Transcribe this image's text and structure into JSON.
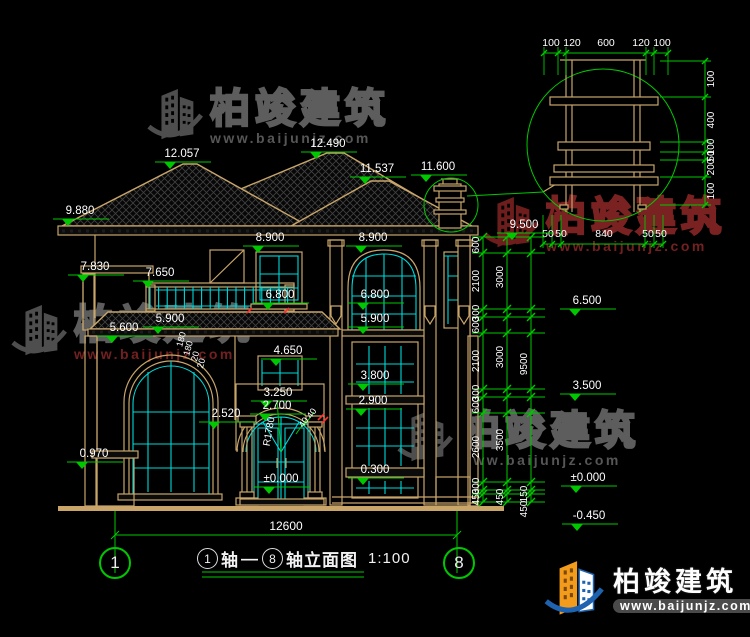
{
  "watermark": {
    "brand": "柏竣建筑",
    "url": "www.baijunjz.com"
  },
  "logo": {
    "brand": "柏竣建筑",
    "url": "www.baijunjz.com"
  },
  "caption": {
    "from": "1",
    "word1": "轴",
    "dash": "—",
    "to": "8",
    "word2": "轴立面图",
    "scale": "1:100"
  },
  "axes": {
    "left": "1",
    "right": "8"
  },
  "dims": {
    "overall": "12600"
  },
  "colors": {
    "green": "#00c800",
    "tan": "#c9a56a",
    "cyan": "#00d8d8",
    "white": "#ffffff",
    "red": "#ff3030"
  },
  "anno": {
    "levels": [
      {
        "t": "12.057",
        "x": 182,
        "y": 157
      },
      {
        "t": "12.490",
        "x": 328,
        "y": 147
      },
      {
        "t": "11.537",
        "x": 377,
        "y": 172
      },
      {
        "t": "11.600",
        "x": 438,
        "y": 170
      },
      {
        "t": "9.880",
        "x": 80,
        "y": 214
      },
      {
        "t": "8.900",
        "x": 270,
        "y": 241
      },
      {
        "t": "8.900",
        "x": 373,
        "y": 241
      },
      {
        "t": "7.830",
        "x": 95,
        "y": 270
      },
      {
        "t": "7.650",
        "x": 160,
        "y": 276
      },
      {
        "t": "6.800",
        "x": 280,
        "y": 298
      },
      {
        "t": "6.800",
        "x": 375,
        "y": 298
      },
      {
        "t": "5.900",
        "x": 170,
        "y": 322
      },
      {
        "t": "5.900",
        "x": 375,
        "y": 322
      },
      {
        "t": "5.600",
        "x": 124,
        "y": 331
      },
      {
        "t": "4.650",
        "x": 288,
        "y": 354
      },
      {
        "t": "3.800",
        "x": 375,
        "y": 379
      },
      {
        "t": "3.250",
        "x": 278,
        "y": 396
      },
      {
        "t": "2.700",
        "x": 277,
        "y": 409
      },
      {
        "t": "2.900",
        "x": 373,
        "y": 404
      },
      {
        "t": "2.520",
        "x": 226,
        "y": 417
      },
      {
        "t": "0.970",
        "x": 94,
        "y": 457
      },
      {
        "t": "0.300",
        "x": 375,
        "y": 473
      },
      {
        "t": "±0.000",
        "x": 281,
        "y": 482
      },
      {
        "t": "9.500",
        "x": 524,
        "y": 228
      },
      {
        "t": "6.500",
        "x": 587,
        "y": 304
      },
      {
        "t": "3.500",
        "x": 587,
        "y": 389
      },
      {
        "t": "±0.000",
        "x": 588,
        "y": 481
      },
      {
        "t": "-0.450",
        "x": 589,
        "y": 519
      }
    ],
    "chain_tick_ys": [
      237,
      253,
      309,
      317,
      333,
      389,
      397,
      413,
      482,
      490,
      494,
      502
    ],
    "chains": [
      {
        "x": 483,
        "labels": [
          [
            "600",
            245
          ],
          [
            "2100",
            281
          ],
          [
            "300",
            313
          ],
          [
            "600",
            325
          ],
          [
            "2100",
            361
          ],
          [
            "300",
            393
          ],
          [
            "600",
            405
          ],
          [
            "2600",
            447
          ],
          [
            "300",
            486
          ],
          [
            "450",
            497
          ]
        ]
      },
      {
        "x": 507,
        "labels": [
          [
            "3000",
            277
          ],
          [
            "3000",
            357
          ],
          [
            "3500",
            440
          ],
          [
            "450",
            497
          ]
        ]
      },
      {
        "x": 531,
        "labels": [
          [
            "9500",
            364
          ],
          [
            "150",
            494
          ],
          [
            "450",
            509
          ]
        ]
      }
    ],
    "detail": {
      "circle": {
        "cx": 603,
        "cy": 145,
        "r": 76
      },
      "top_labels": [
        [
          "100",
          551
        ],
        [
          "120",
          572
        ],
        [
          "600",
          606
        ],
        [
          "120",
          641
        ],
        [
          "100",
          662
        ]
      ],
      "top_tick_xs": [
        544,
        558,
        566,
        646,
        654,
        668
      ],
      "top_line_y": 53,
      "top_text_y": 46,
      "right_labels": [
        [
          "100",
          79
        ],
        [
          "400",
          120
        ],
        [
          "100",
          147
        ],
        [
          "50",
          156
        ],
        [
          "200",
          167
        ],
        [
          "100",
          191
        ]
      ],
      "right_tick_ys": [
        61,
        97,
        142,
        152,
        160,
        177,
        205
      ],
      "right_line_x": 705,
      "bottom_labels": [
        [
          "50",
          548
        ],
        [
          "50",
          561
        ],
        [
          "840",
          604
        ],
        [
          "50",
          648
        ],
        [
          "50",
          661
        ]
      ],
      "bottom_tick_xs": [
        543,
        552,
        561,
        645,
        654,
        663
      ],
      "bottom_line_y": 244,
      "bottom_text_y": 237
    },
    "texts": [
      {
        "t": "R1780",
        "x": 272,
        "y": 432,
        "r": -80,
        "s": 10
      },
      {
        "t": "40",
        "x": 306,
        "y": 424,
        "r": -55,
        "s": 9
      },
      {
        "t": "40",
        "x": 314,
        "y": 415,
        "r": -55,
        "s": 9
      },
      {
        "t": "180",
        "x": 184,
        "y": 340,
        "r": -75,
        "s": 9
      },
      {
        "t": "180",
        "x": 191,
        "y": 349,
        "r": -75,
        "s": 9
      },
      {
        "t": "20",
        "x": 198,
        "y": 357,
        "r": -75,
        "s": 9
      },
      {
        "t": "20",
        "x": 204,
        "y": 364,
        "r": -75,
        "s": 9
      }
    ]
  }
}
